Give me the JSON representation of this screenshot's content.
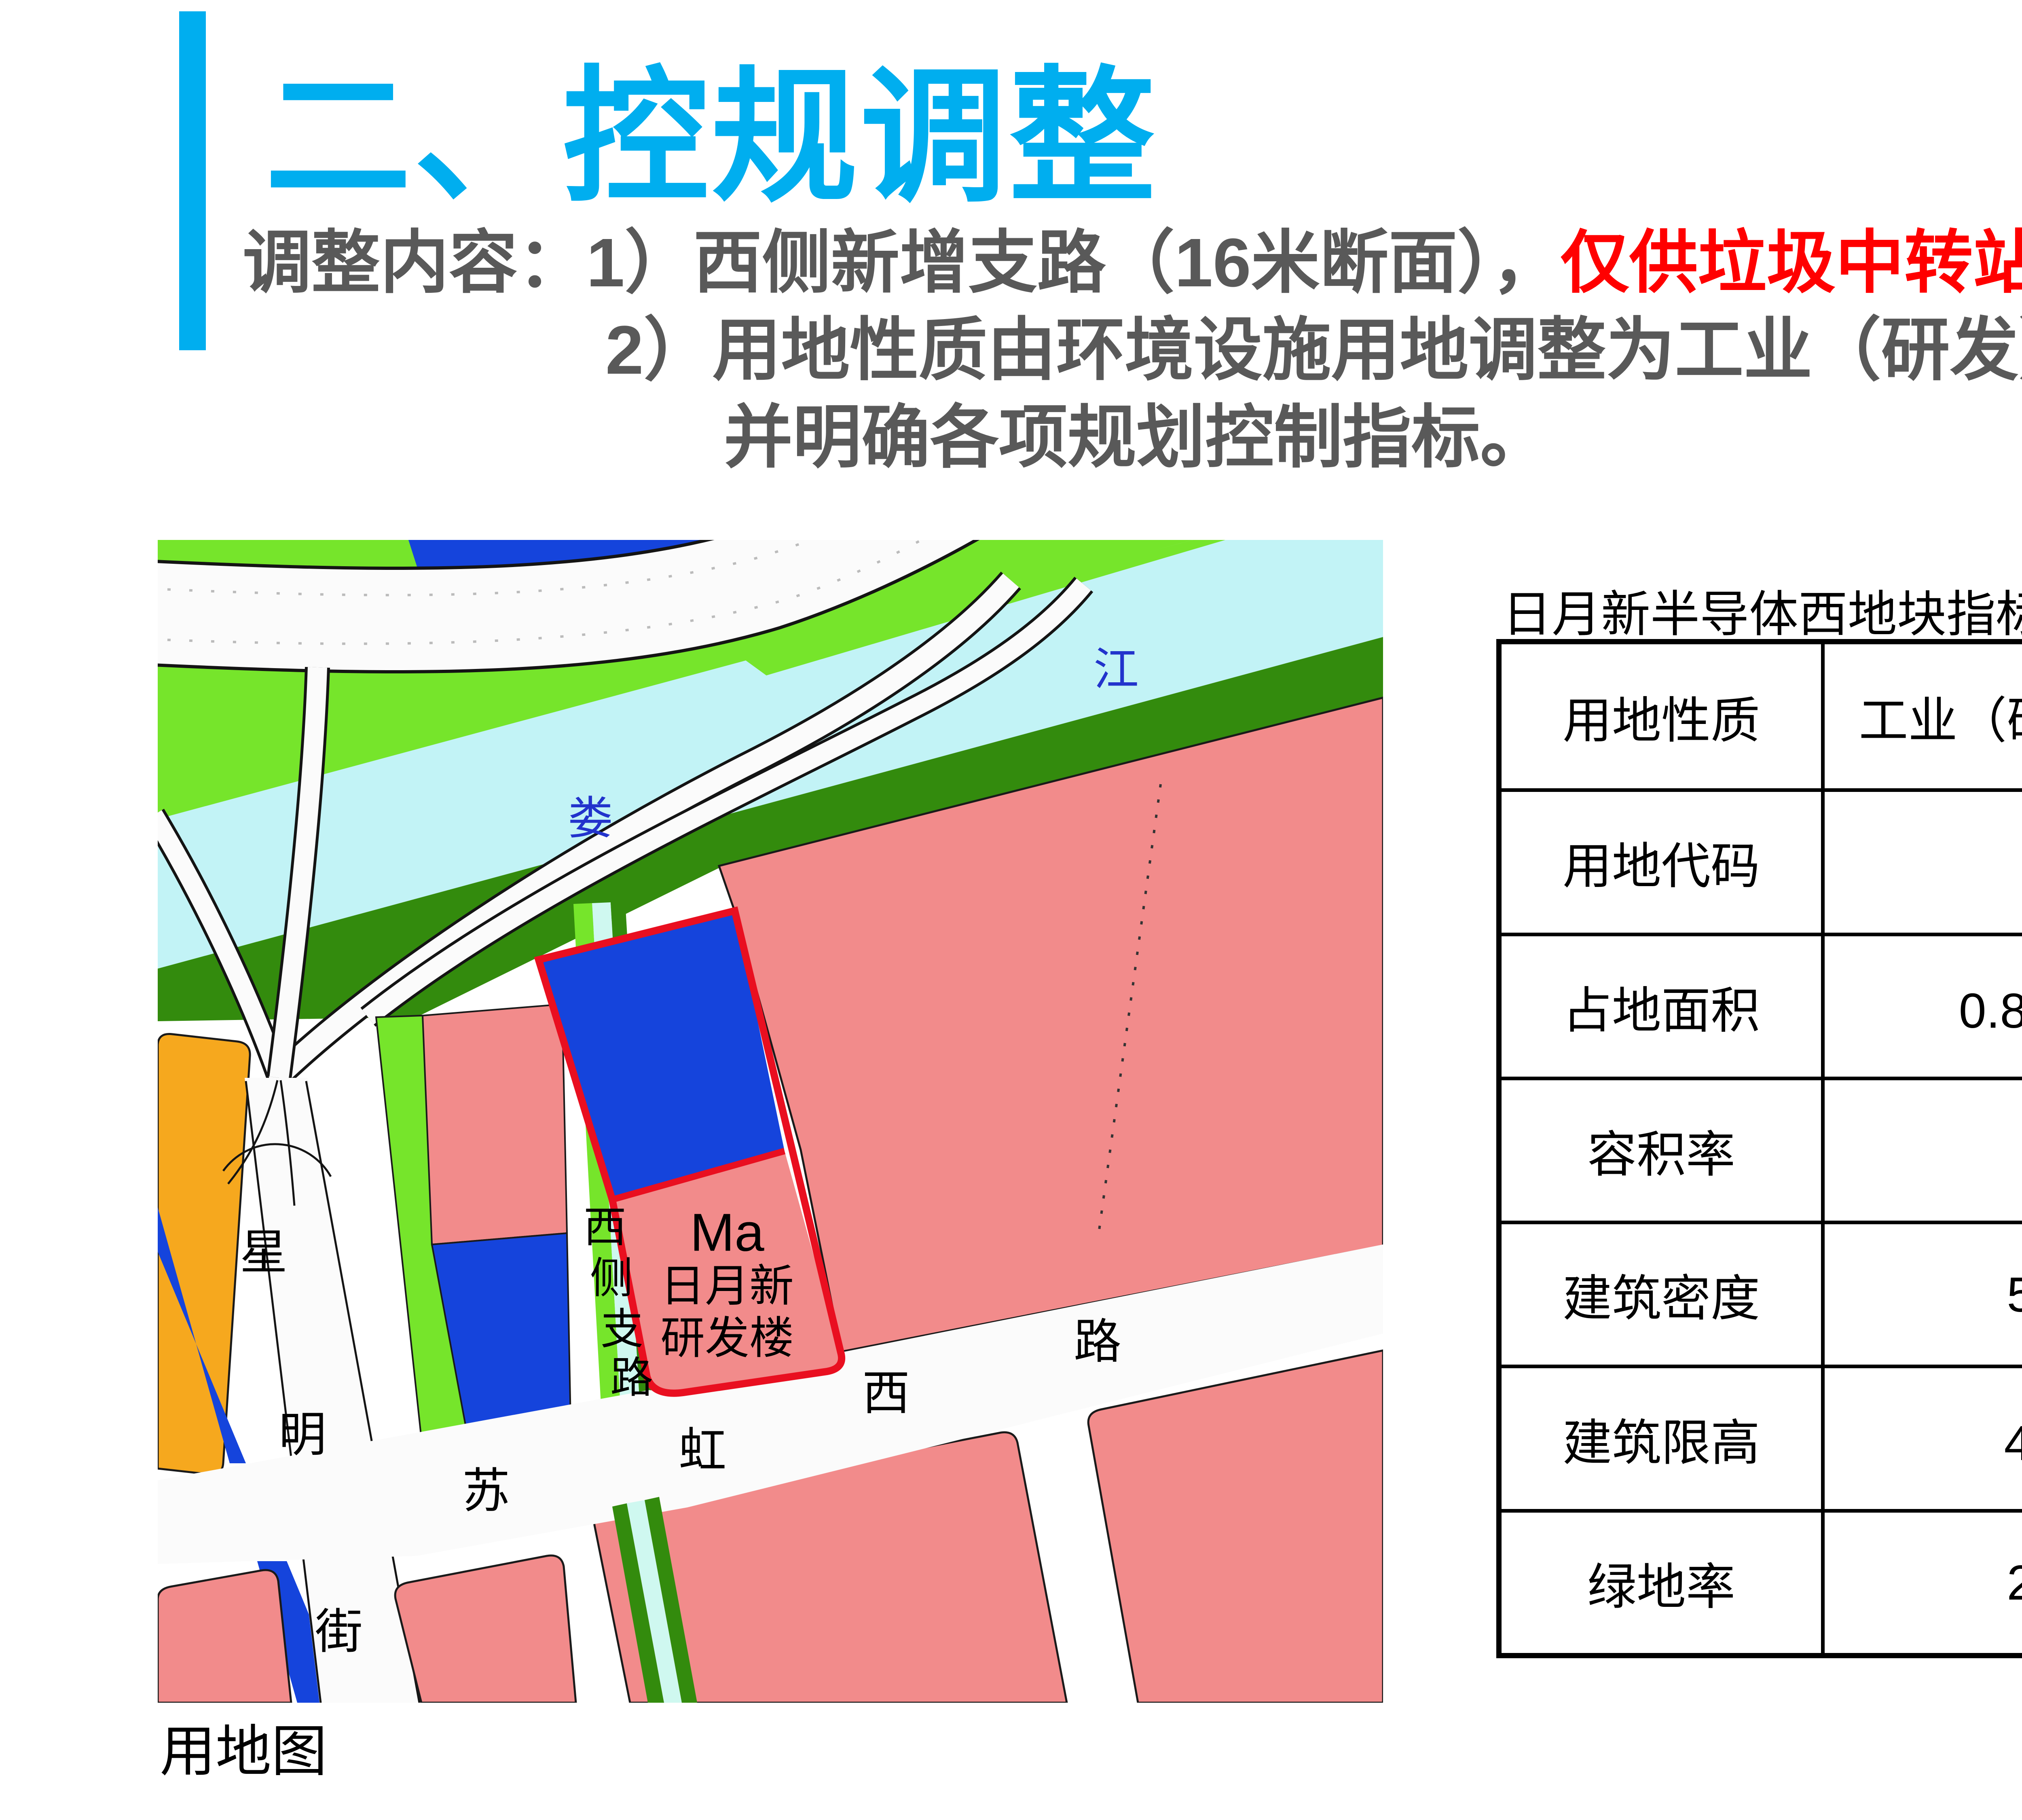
{
  "slide": {
    "title": "二、控规调整",
    "accent_color": "#00AEEF",
    "body": {
      "line1_gray": "调整内容：1）西侧新增支路（16米断面），",
      "line1_red": "仅供垃圾中转站使用；",
      "line2": "2）用地性质由环境设施用地调整为工业（研发）用地，",
      "line3": "并明确各项规划控制指标。",
      "gray_color": "#595959",
      "red_color": "#FF0000"
    }
  },
  "map": {
    "caption": "用地图",
    "labels": {
      "river_char1": "娄",
      "river_char2": "江",
      "street_xing": "星",
      "street_ming": "明",
      "street_jie": "街",
      "road_su": "苏",
      "road_hong": "虹",
      "road_xi": "西",
      "road_lu": "路",
      "branch_road": [
        "西",
        "侧",
        "支",
        "路"
      ],
      "parcel_code": "Ma",
      "parcel_name_line1": "日月新",
      "parcel_name_line2": "研发楼"
    },
    "colors": {
      "lime_green": "#76E52B",
      "dark_green": "#338B0D",
      "river_cyan": "#C2F3F6",
      "parcel_pink": "#F28B8B",
      "parcel_blue": "#1544DC",
      "orange": "#F6A81E",
      "red_boundary": "#E90F20",
      "water_label_blue": "#2233CC"
    }
  },
  "table": {
    "title": "日月新半导体西地块指标一览表",
    "rows": [
      {
        "label": "用地性质",
        "value": "工业（研发）用地"
      },
      {
        "label": "用地代码",
        "value": "Ma"
      },
      {
        "label": "占地面积",
        "value": "0.83公顷"
      },
      {
        "label": "容积率",
        "value": "1.9"
      },
      {
        "label": "建筑密度",
        "value": "50%"
      },
      {
        "label": "建筑限高",
        "value": "40米"
      },
      {
        "label": "绿地率",
        "value": "20%"
      }
    ]
  }
}
